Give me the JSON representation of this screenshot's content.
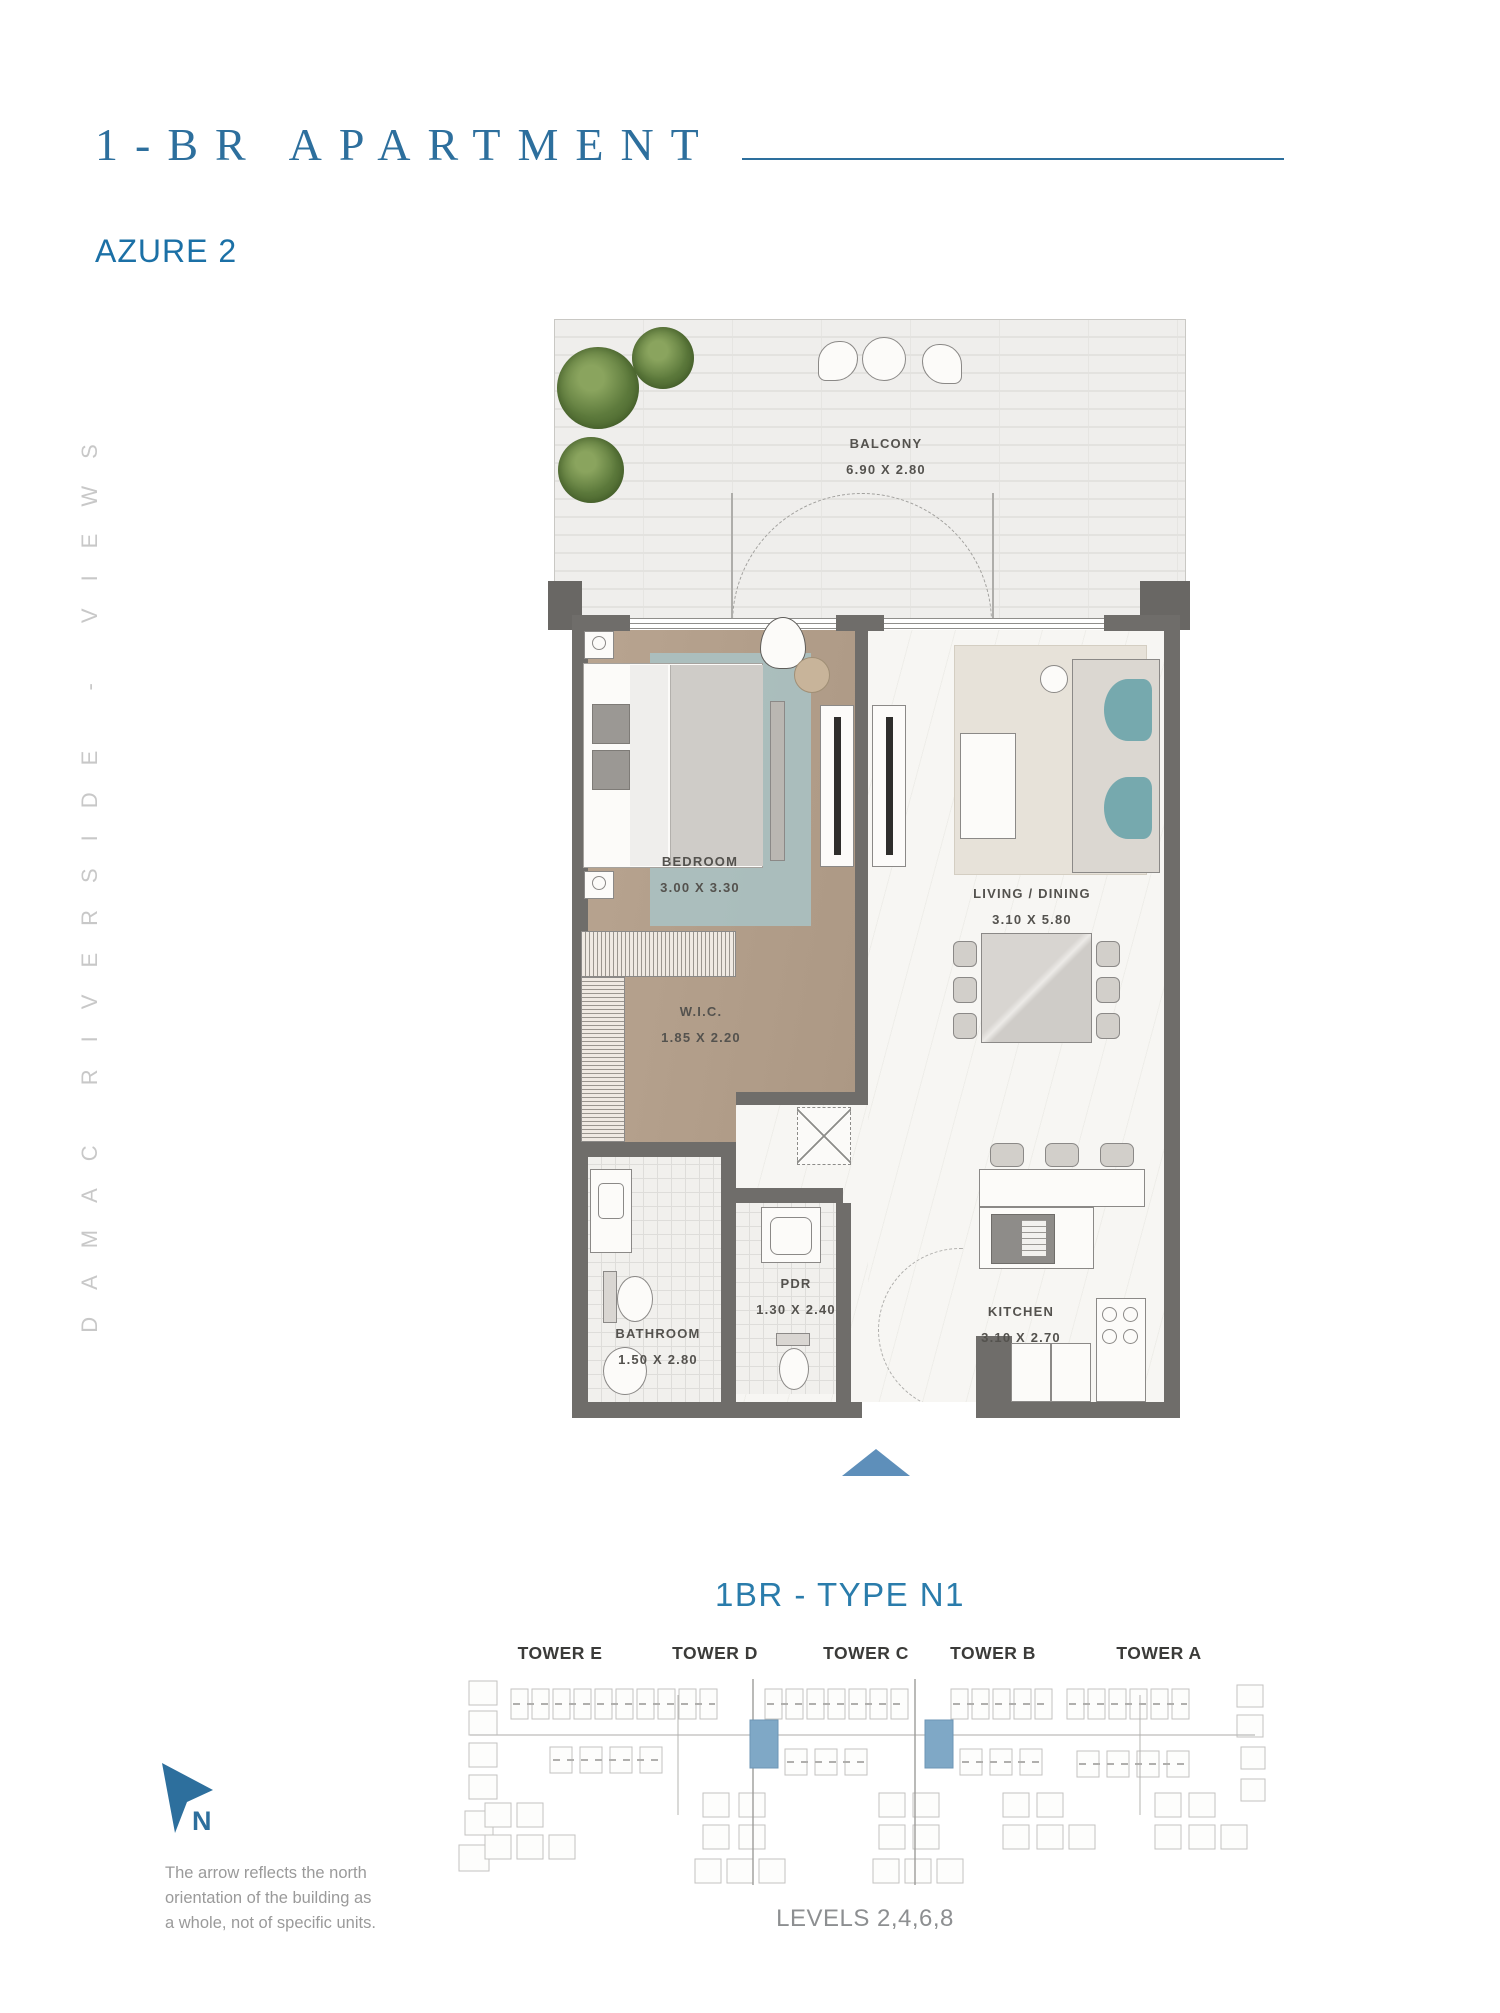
{
  "header": {
    "title": "1-BR APARTMENT",
    "subtitle": "AZURE 2"
  },
  "side_text": "DAMAC RIVERSIDE - VIEWS",
  "floor_plan": {
    "rooms": [
      {
        "name": "BALCONY",
        "dimensions": "6.90 X 2.80"
      },
      {
        "name": "BEDROOM",
        "dimensions": "3.00 X 3.30"
      },
      {
        "name": "LIVING / DINING",
        "dimensions": "3.10 X 5.80"
      },
      {
        "name": "W.I.C.",
        "dimensions": "1.85 X 2.20"
      },
      {
        "name": "BATHROOM",
        "dimensions": "1.50 X 2.80"
      },
      {
        "name": "PDR",
        "dimensions": "1.30 X 2.40"
      },
      {
        "name": "KITCHEN",
        "dimensions": "3.10 X 2.70"
      }
    ]
  },
  "unit": {
    "type_label": "1BR - TYPE N1",
    "levels_label": "LEVELS 2,4,6,8"
  },
  "site_plan": {
    "towers": [
      "TOWER E",
      "TOWER D",
      "TOWER C",
      "TOWER B",
      "TOWER A"
    ]
  },
  "compass": {
    "north_label": "N",
    "note_lines": [
      "The arrow reflects the north",
      "orientation of  the building as",
      "a whole, not of specific units."
    ]
  },
  "colors": {
    "accent_blue": "#2d6f9d",
    "type_blue": "#2a7cab",
    "wall_gray": "#6f6d6a",
    "bedroom_floor": "#b7a28c",
    "rug_teal": "#a9c6c9",
    "sofa_teal": "#76a9ae",
    "tree_green": "#5d7a3c",
    "entry_arrow": "#5e8fba",
    "unit_highlight": "#7fa8c6",
    "side_text_gray": "#c8c8c8"
  }
}
